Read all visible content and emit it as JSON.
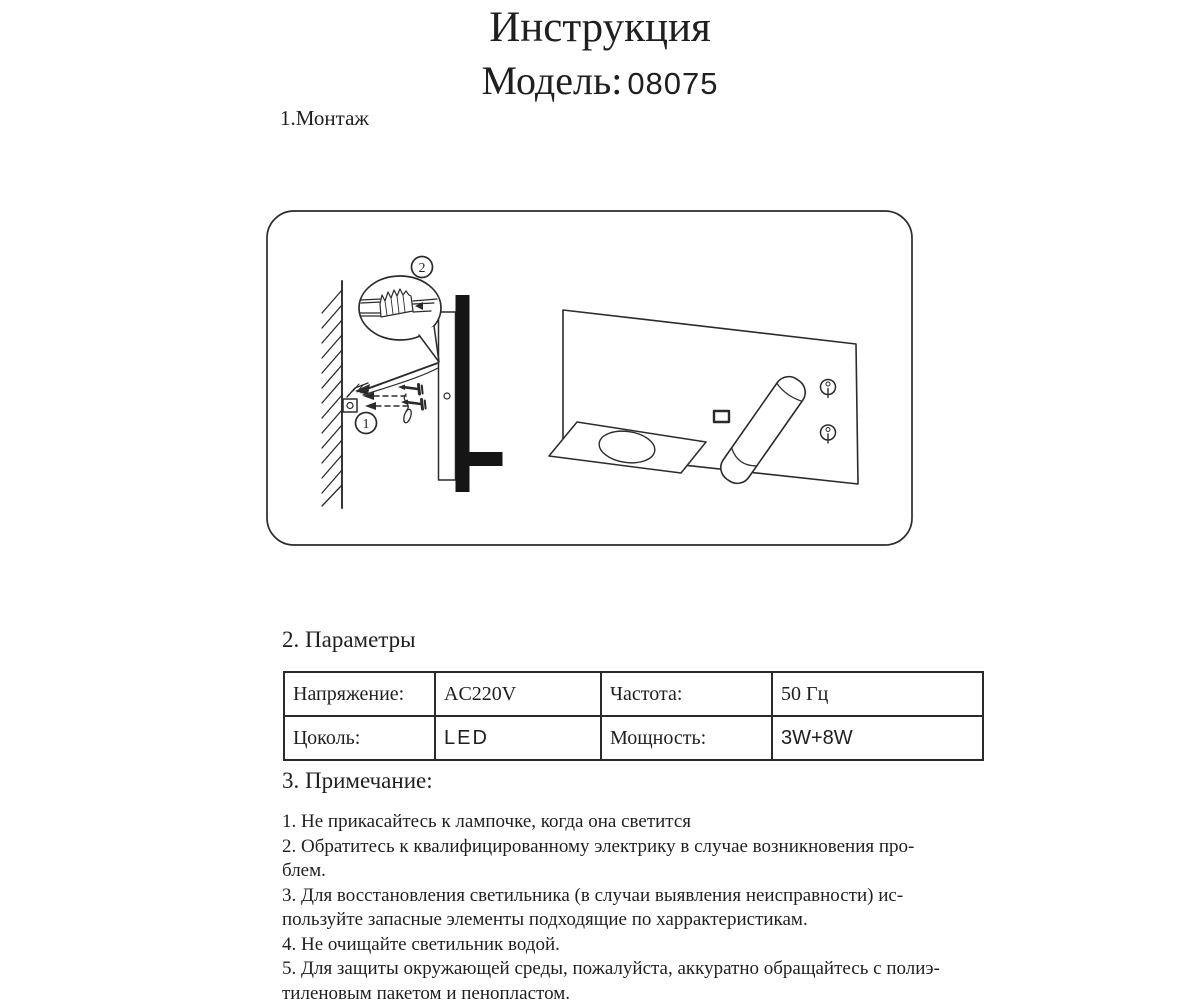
{
  "header": {
    "title": "Инструкция",
    "model_label": "Модель:",
    "model_number": "08075"
  },
  "sections": {
    "mounting_heading": "1.Монтаж",
    "parameters_heading": "2. Параметры",
    "notes_heading": "3. Примечание:"
  },
  "diagram": {
    "description": "wall-mounted-reading-lamp-installation",
    "step_labels": [
      "1",
      "2"
    ]
  },
  "parameters_table": {
    "rows": [
      {
        "cells": [
          "Напряжение:",
          "AC220V",
          "Частота:",
          "50 Гц"
        ]
      },
      {
        "cells": [
          "Цоколь:",
          "LED",
          "Мощность:",
          "3W+8W"
        ]
      }
    ]
  },
  "notes": {
    "lines": [
      "1. Не прикасайтесь к лампочке, когда она светится",
      "2. Обратитесь к квалифицированному электрику в случае возникновения про-",
      "блем.",
      "3. Для восстановления светильника (в случаи выявления неисправности) ис-",
      "пользуйте запасные элементы подходящие по харрактеристикам.",
      "4. Не очищайте  светильник водой.",
      "5. Для защиты окружающей среды, пожалуйста, аккуратно обращайтесь с полиэ-",
      "тиленовым пакетом и пенопластом."
    ]
  }
}
